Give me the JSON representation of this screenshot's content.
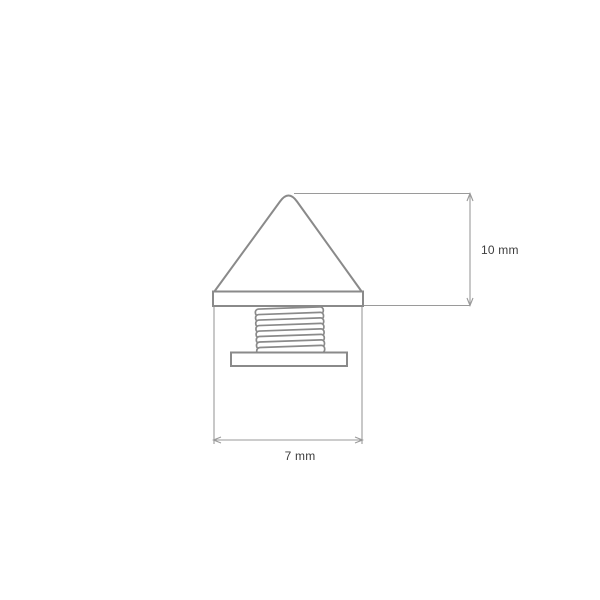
{
  "drawing": {
    "height_dimension": {
      "label": "10 mm"
    },
    "width_dimension": {
      "label": "7 mm"
    },
    "colors": {
      "outline": "#8a8a8a",
      "thin_line": "#9a9a9a",
      "label_text": "#3d3d3d",
      "background": "#ffffff"
    }
  }
}
